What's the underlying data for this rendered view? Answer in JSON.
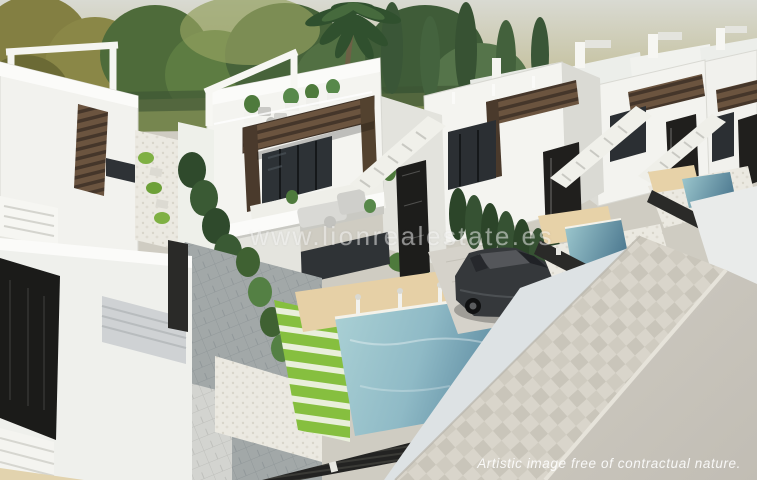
{
  "image": {
    "type": "3d-architectural-render",
    "subject": "Aerial view of a row of modern white new-build villas with rooftop terraces, wooden pergolas, private pools, striped lawns, a parked car and a street in the foreground",
    "watermark": "www.lionrealestate.es",
    "disclaimer": "Artistic image free of contractual nature."
  },
  "palette": {
    "sky_haze": "#b3aa72",
    "tree_green": "#4a653a",
    "villa_white": "#f4f4f0",
    "villa_shadow": "#d9d9d3",
    "pergola_wood": "#5a4636",
    "feature_wall_black": "#1f1e1c",
    "pool_water_light": "#a9cfd4",
    "pool_water_deep": "#5d8ba1",
    "deck_beige": "#e6d0a6",
    "grass_green": "#86bf3f",
    "gravel_white": "#eae8e0",
    "road_gray": "#c7c3ba",
    "car_charcoal": "#35383b"
  },
  "scene_elements": [
    "background-trees",
    "palm-tree",
    "cypress-trees",
    "left-villa",
    "center-villa",
    "right-villas",
    "rooftop-pergola",
    "roof-terrace-furniture",
    "main-pool",
    "second-pool",
    "third-pool",
    "pool-decks",
    "striped-lawn",
    "gravel-garden",
    "cypress-hedge",
    "black-slat-fence",
    "garage-door",
    "driveway",
    "parked-car",
    "paved-sidewalk",
    "road",
    "stairs"
  ]
}
